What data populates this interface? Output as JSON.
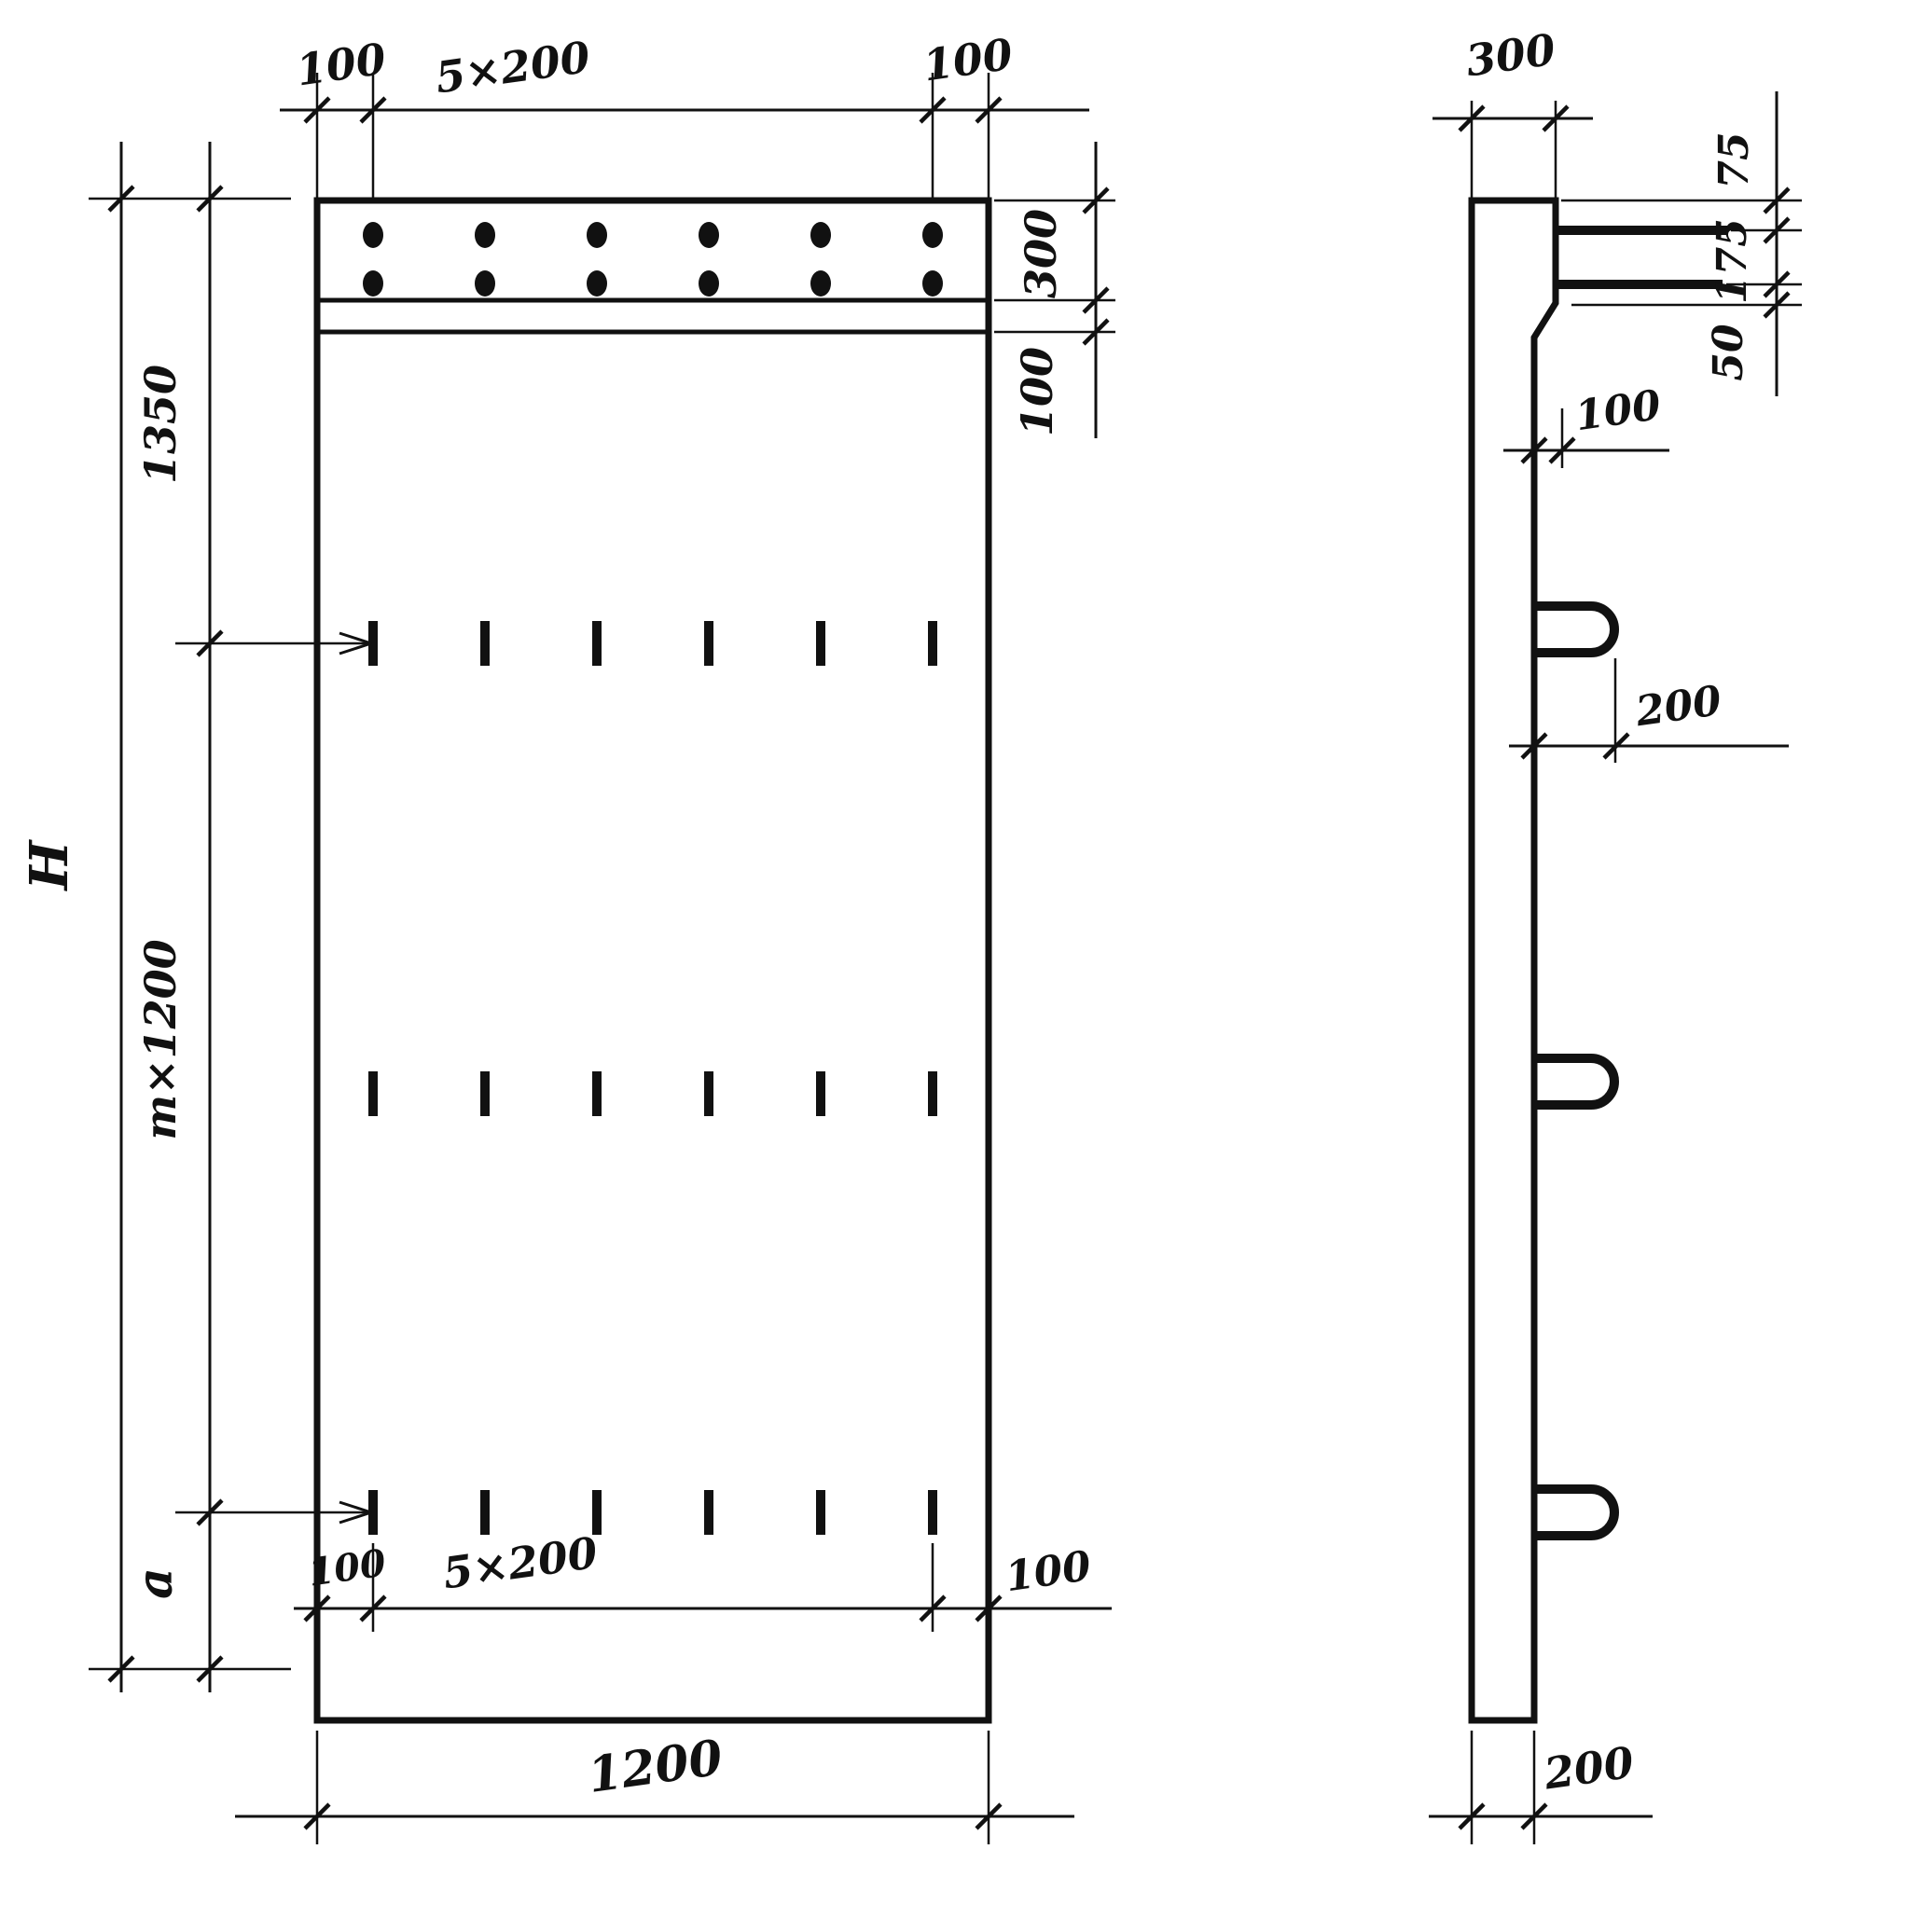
{
  "front_view": {
    "dim_top_left": "100",
    "dim_top_center": "5×200",
    "dim_top_right": "100",
    "dim_right_strip": "300",
    "dim_right_gap": "100",
    "dim_left_top": "1350",
    "dim_left_middle": "m×1200",
    "dim_left_bottom": "a",
    "dim_left_overall": "H",
    "dim_bottom_left": "100",
    "dim_bottom_center": "5×200",
    "dim_bottom_right": "100",
    "dim_bottom_overall": "1200"
  },
  "side_view": {
    "dim_top_width": "300",
    "dim_right_top": "75",
    "dim_right_middle": "175",
    "dim_right_bottom": "50",
    "dim_step": "100",
    "dim_hook_offset": "200",
    "dim_bottom_width": "200"
  }
}
